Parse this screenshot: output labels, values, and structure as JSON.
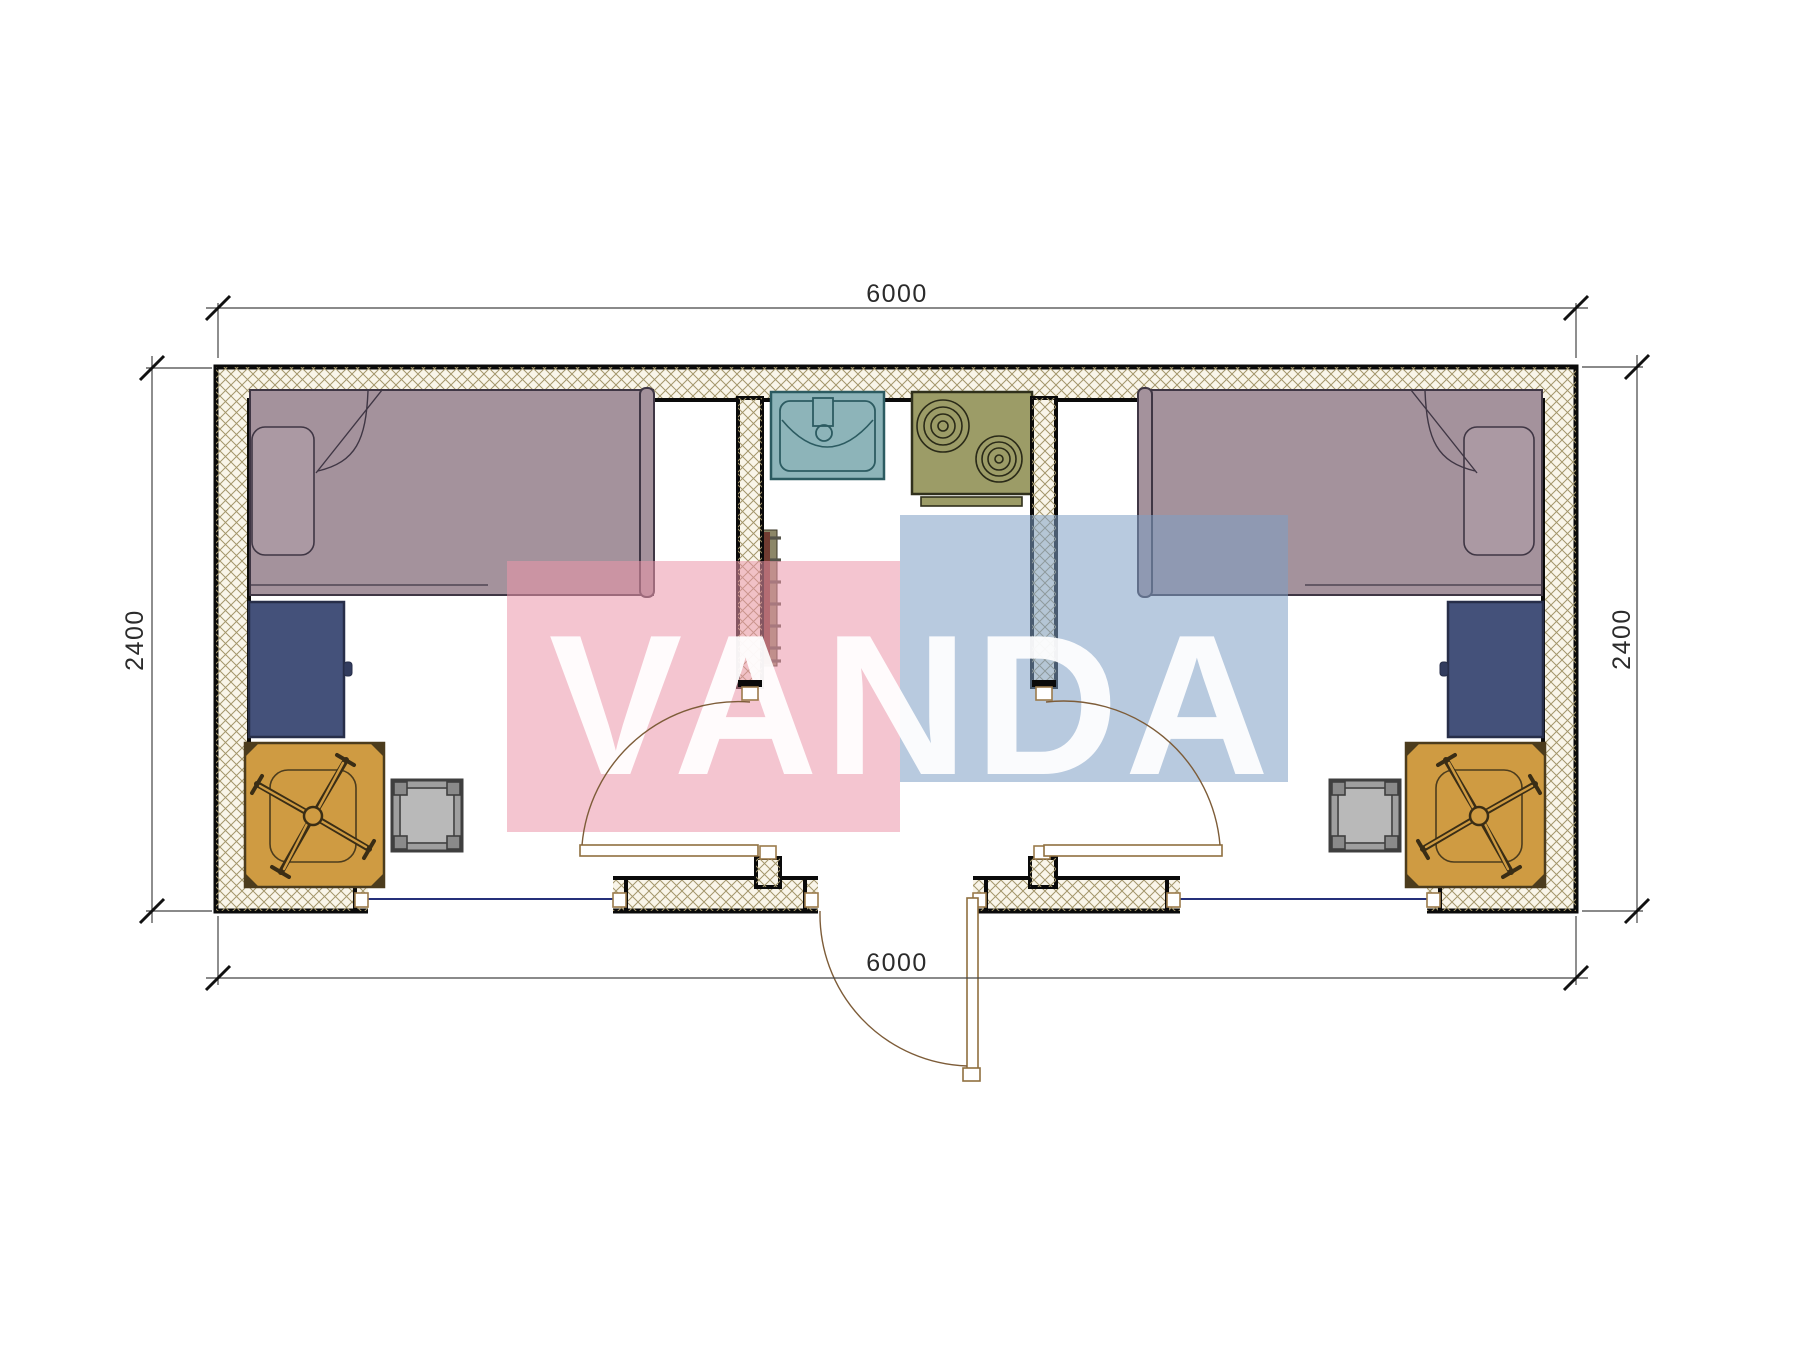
{
  "drawing": {
    "type": "floor-plan",
    "dimensions": {
      "top_label": "6000",
      "bottom_label": "6000",
      "left_label": "2400",
      "right_label": "2400"
    },
    "watermark": {
      "text": "VANDA",
      "pink_block_color": "#eb96a9",
      "blue_block_color": "#7e9ec5",
      "text_color": "#ffffff"
    },
    "elements": [
      "bed-left",
      "pillow-left",
      "desk-left",
      "chair-left",
      "chair-mat-left",
      "stool-left",
      "sink",
      "stove",
      "radiator",
      "bed-right",
      "pillow-right",
      "desk-right",
      "chair-right",
      "chair-mat-right",
      "stool-right",
      "window-left",
      "window-right",
      "entry-door",
      "room-door-left",
      "room-door-right"
    ],
    "colors": {
      "wall_hatch_line": "#a3966b",
      "wall_hatch_bg": "#f9f5e9",
      "wall_outline": "#0a0a0a",
      "bed": "#a4929c",
      "pillow": "#ab99a3",
      "desk": "#44517a",
      "chair_mat": "#cf9b42",
      "stool": "#9f9f9f",
      "sink": "#8db4b9",
      "stove": "#9c9c67",
      "radiator": "#713b31",
      "door_line": "#8f6f3f",
      "window_line": "#25307a",
      "dimension_line": "#333333"
    }
  }
}
